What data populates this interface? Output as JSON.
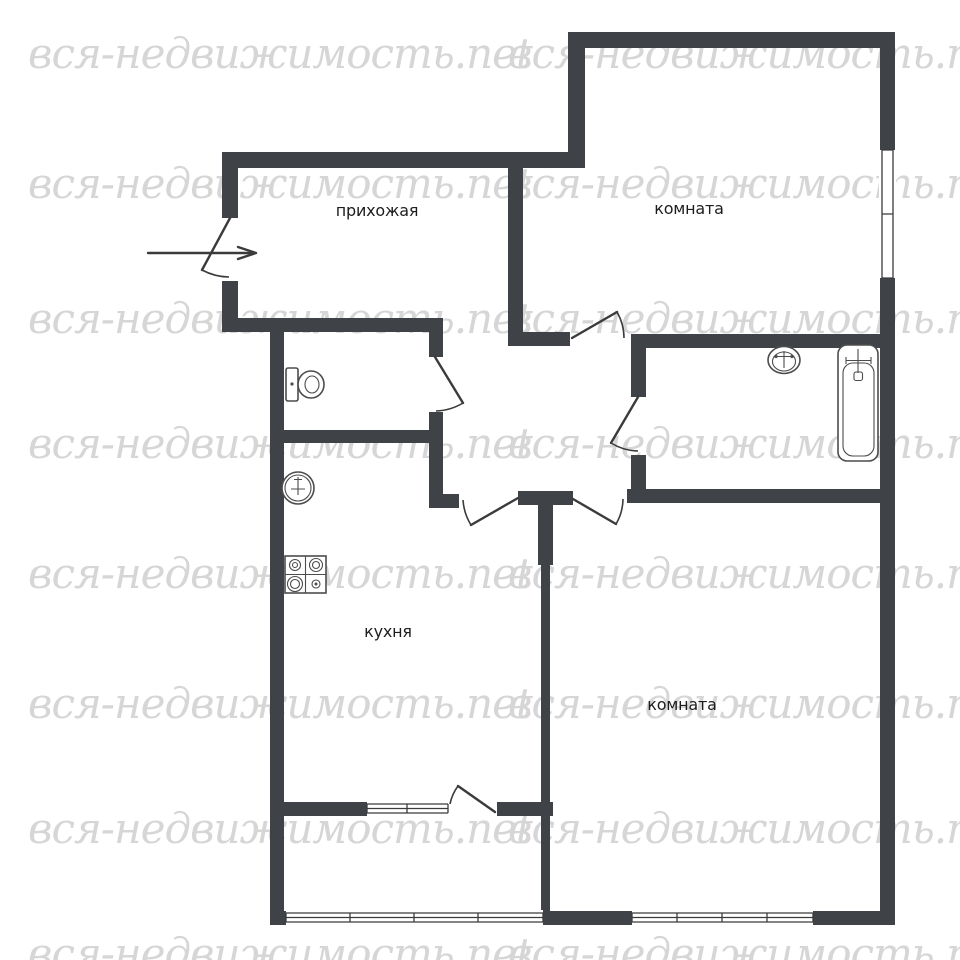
{
  "page": {
    "title": "Floor plan"
  },
  "watermark": {
    "text": "вся-недвижимость.net",
    "color": "#d6d6d6"
  },
  "rooms": {
    "hallway": {
      "label": "прихожая"
    },
    "room_top": {
      "label": "комната"
    },
    "kitchen": {
      "label": "кухня"
    },
    "room_bottom": {
      "label": "комната"
    }
  },
  "fixtures": [
    {
      "name": "toilet-icon",
      "location": "wc"
    },
    {
      "name": "sink-icon",
      "location": "kitchen"
    },
    {
      "name": "stove-icon",
      "location": "kitchen"
    },
    {
      "name": "washbasin-icon",
      "location": "bathroom"
    },
    {
      "name": "bathtub-icon",
      "location": "bathroom"
    },
    {
      "name": "entry-arrow-icon",
      "location": "entrance"
    }
  ],
  "colors": {
    "wall": "#3f4347",
    "line": "#3b3b3b",
    "label": "#1d1d1d",
    "background": "#ffffff",
    "watermark": "#d6d6d6"
  }
}
